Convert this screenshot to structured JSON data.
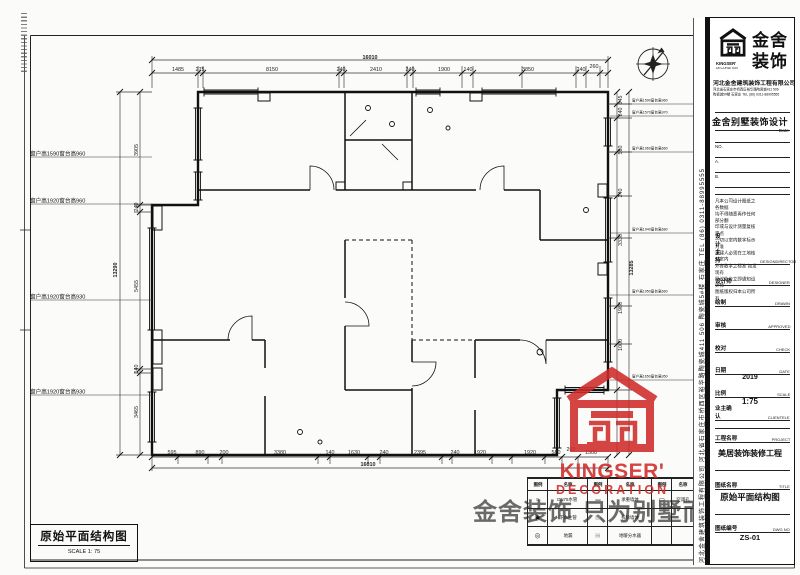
{
  "sheet": {
    "drawing_title": "原始平面结构图",
    "drawing_scale": "SCALE 1: 75"
  },
  "plan": {
    "dims_top": {
      "total": "16010",
      "segments": [
        "1485",
        "275",
        "8150",
        "240",
        "2410",
        "240",
        "1900",
        "140",
        "3850",
        "240",
        "260"
      ]
    },
    "dims_bottom": {
      "total": "16010",
      "segments": [
        "595",
        "890",
        "200",
        "3380",
        "140",
        "1630",
        "240",
        "2395",
        "240",
        "1920",
        "1920",
        "580",
        "200",
        "1500"
      ]
    },
    "dims_left": {
      "total": "13290",
      "segments": [
        "3905",
        "240",
        "5455",
        "140",
        "3465"
      ]
    },
    "dims_right": {
      "total": "13285",
      "segments": [
        "545",
        "240",
        "560",
        "240",
        "3330",
        "1980",
        "1000"
      ]
    },
    "window_labels_left": [
      "窗户高1590窗台高960",
      "窗户高1920窗台高960",
      "窗户高1920窗台高930",
      "窗户高1920窗台高930"
    ],
    "window_labels_right": [
      "窗户高1590窗台高960",
      "窗户高1570窗台高970",
      "窗户高1960窗台高660",
      "窗户高1940窗台高680",
      "窗户高1950窗台高660",
      "窗户高1650窗台高950"
    ]
  },
  "legend": {
    "headers": [
      "图例",
      "名称",
      "图例",
      "名称",
      "图例",
      "名称"
    ],
    "rows": [
      [
        "○",
        "DN75水管",
        "▬",
        "承重墙体",
        "▭",
        "空调孔"
      ],
      [
        "◉",
        "下水主管",
        "▨",
        "拆除墙体",
        "",
        ""
      ],
      [
        "◎",
        "地漏",
        "▤",
        "地暖分水器",
        "",
        ""
      ]
    ]
  },
  "watermark": {
    "slogan": "金舍装饰 只为别墅而生",
    "brand_en1": "KINGSER'",
    "brand_en2": "DECORATION"
  },
  "panel": {
    "brand": {
      "cn1": "金舍",
      "cn2": "装饰",
      "en1": "KINGSER'",
      "en2": "DECORATION"
    },
    "company": "河北金舍建筑装饰工程有限公司",
    "address1": "河北省石家庄市桥西区裕华路陶瓷城411 506",
    "address2": "陶瓷城5#楼 石家庄 TEL (86) 0311-88995555",
    "product": "金舍别墅装饰设计",
    "date_label": "Date",
    "no_labels": [
      "NO.",
      "A.",
      "B."
    ],
    "side_text": "河北金舍建筑装饰工程有限公司  河北省石家庄市桥西区裕华路陶瓷城411 506 陶瓷城5#楼  石家庄 TEL (86) 0311-88995555",
    "disclaimer": "凡本公司设计图纸之各数据\n均不得随意再作任何部分翻\n印或与设计测量复核定点\n一切以室内数字标示为准\n承建人必须在工地核对室内\n外各数字之标准 如发现有\n异议处应立即通知设计师\n图纸版权归本公司所有",
    "rows": [
      {
        "cn": "设计主持",
        "en": "DESIGNDIRECTOR",
        "value": ""
      },
      {
        "cn": "设计师",
        "en": "DESIGNER",
        "value": ""
      },
      {
        "cn": "绘制",
        "en": "DRAWN",
        "value": ""
      },
      {
        "cn": "审核",
        "en": "APPROVED",
        "value": ""
      },
      {
        "cn": "校对",
        "en": "CHECK",
        "value": ""
      },
      {
        "cn": "日期",
        "en": "DATE",
        "value": "2019"
      },
      {
        "cn": "比例",
        "en": "SCALE",
        "value": "1:75"
      },
      {
        "cn": "业主确认",
        "en": "CLIENTELE",
        "value": ""
      },
      {
        "cn": "工程名称",
        "en": "PROJECT",
        "value": "美居装饰装修工程"
      },
      {
        "cn": "图纸名称",
        "en": "TITLE",
        "value": "原始平面结构图"
      },
      {
        "cn": "图纸编号",
        "en": "DWG NO",
        "value": "ZS-01"
      }
    ]
  },
  "colors": {
    "line": "#1a1a1a",
    "red": "#cf2b2a",
    "watermark_gray": "#555555"
  }
}
